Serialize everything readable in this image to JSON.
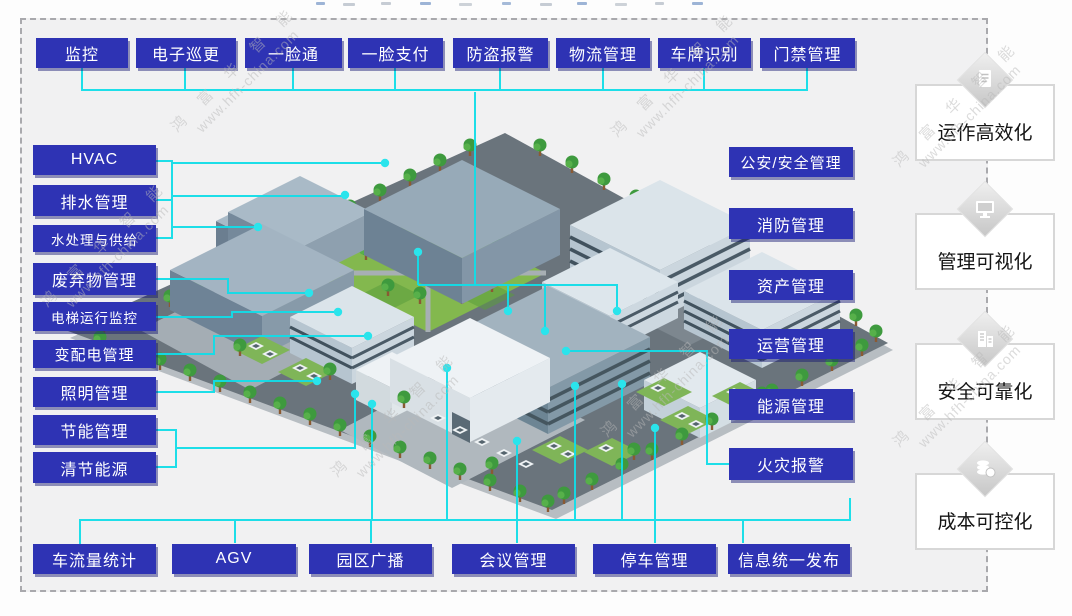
{
  "diagram_title_fragments_visible": true,
  "top_modules": [
    "监控",
    "电子巡更",
    "一脸通",
    "一脸支付",
    "防盗报警",
    "物流管理",
    "车牌识别",
    "门禁管理"
  ],
  "left_modules": [
    "HVAC",
    "排水管理",
    "水处理与供给",
    "废弃物管理",
    "电梯运行监控",
    "变配电管理",
    "照明管理",
    "节能管理",
    "清节能源"
  ],
  "right_modules": [
    "公安/安全管理",
    "消防管理",
    "资产管理",
    "运营管理",
    "能源管理",
    "火灾报警"
  ],
  "bottom_modules": [
    "车流量统计",
    "AGV",
    "园区广播",
    "会议管理",
    "停车管理",
    "信息统一发布"
  ],
  "benefits": [
    {
      "label": "运作高效化",
      "icon": "document-icon"
    },
    {
      "label": "管理可视化",
      "icon": "monitor-icon"
    },
    {
      "label": "安全可靠化",
      "icon": "building-icon"
    },
    {
      "label": "成本可控化",
      "icon": "coins-icon"
    }
  ],
  "watermark": {
    "brand": "鸿 富 华 智 能",
    "url": "www.hfh-china.com"
  },
  "colors": {
    "module_blue": "#2e33b4",
    "connector_cyan": "#12dde8",
    "panel_border": "#d7d7d7",
    "dashed_border": "#a9a9ad",
    "platform_gray": "#6a747c",
    "park_green": "#83b84e"
  }
}
